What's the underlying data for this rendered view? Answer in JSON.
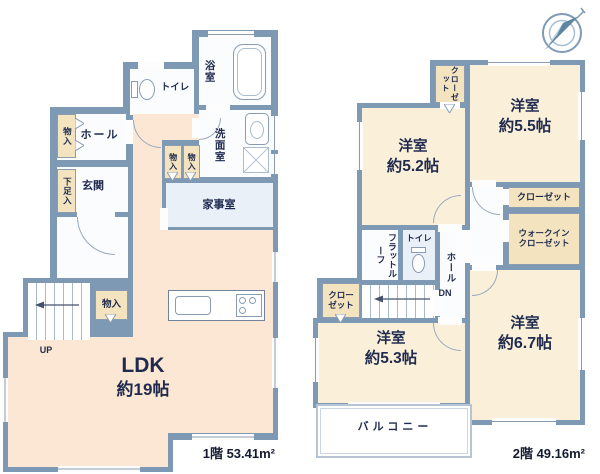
{
  "colors": {
    "wall": "#7e99b4",
    "room_cream": "#faf0da",
    "room_peach": "#fbe7d3",
    "room_white": "#fafcfe",
    "room_blue": "#e9f0f7",
    "closet_beige": "#f3e4bf",
    "ink": "#1f2a4e",
    "line": "#8b9cb1"
  },
  "compass": {
    "icon": "north-compass"
  },
  "floor1": {
    "area_label": "1階 53.41m²",
    "ldk_name": "LDK",
    "ldk_size": "約19帖",
    "entrance": "玄関",
    "hall": "ホール",
    "bath": "浴室",
    "toilet": "トイレ",
    "washroom": "洗面室",
    "utility": "家事室",
    "shoe_storage": "下足入",
    "storage_hall": "物入",
    "storage_a": "物入",
    "storage_b": "物入",
    "storage_ldk": "物入",
    "up": "UP"
  },
  "floor2": {
    "area_label": "2階 49.16m²",
    "bed52_name": "洋室",
    "bed52_size": "約5.2帖",
    "bed55_name": "洋室",
    "bed55_size": "約5.5帖",
    "bed53_name": "洋室",
    "bed53_size": "約5.3帖",
    "bed67_name": "洋室",
    "bed67_size": "約6.7帖",
    "closet_top_1": "クロー",
    "closet_top_2": "ゼット",
    "closet_mid": "クローゼット",
    "closet_left_1": "クロー",
    "closet_left_2": "ゼット",
    "wic_1": "ウォークイン",
    "wic_2": "クローゼット",
    "flat_roof_1": "フラット",
    "flat_roof_2": "ルーフ",
    "toilet": "トイレ",
    "hall": "ホール",
    "balcony": "バルコニー",
    "dn": "DN"
  }
}
